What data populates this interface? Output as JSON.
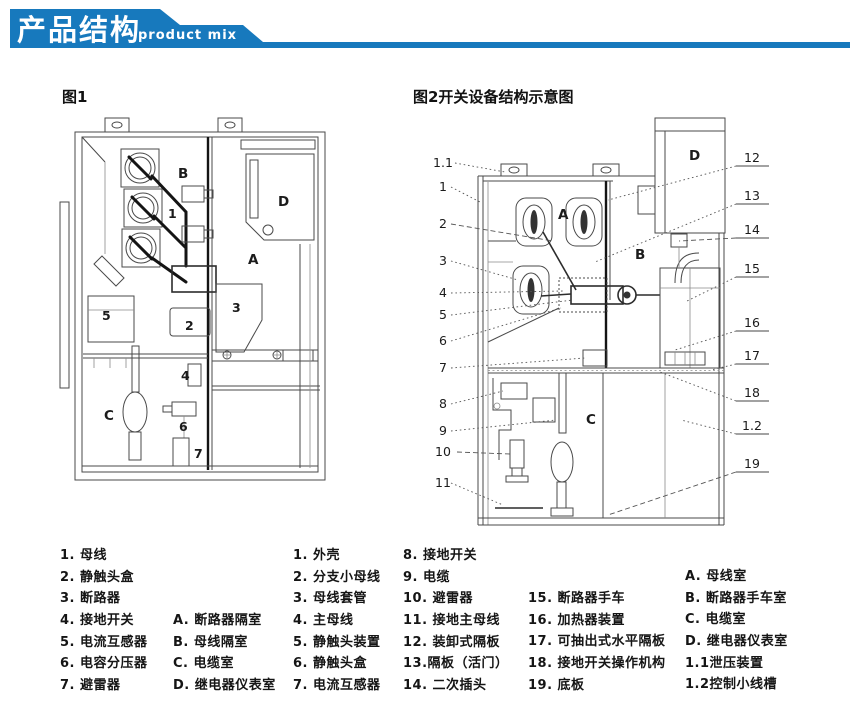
{
  "header": {
    "title": "产品结构",
    "subtitle": "product mix",
    "banner_color": "#1779bd"
  },
  "figures": {
    "fig1": {
      "caption": "图1",
      "part_labels": [
        "1",
        "2",
        "3",
        "4",
        "5",
        "6",
        "7"
      ],
      "compartment_labels": [
        "A",
        "B",
        "C",
        "D"
      ]
    },
    "fig2": {
      "caption": "图2开关设备结构示意图",
      "left_callouts": [
        "1.1",
        "1",
        "2",
        "3",
        "4",
        "5",
        "6",
        "7",
        "8",
        "9",
        "10",
        "11"
      ],
      "right_callouts": [
        "12",
        "13",
        "14",
        "15",
        "16",
        "17",
        "18",
        "1.2",
        "19"
      ],
      "compartment_labels": [
        "A",
        "B",
        "C",
        "D"
      ]
    }
  },
  "legend": {
    "fig1_parts": [
      "1. 母线",
      "2. 静触头盒",
      "3. 断路器",
      "4. 接地开关",
      "5. 电流互感器",
      "6. 电容分压器",
      "7. 避雷器"
    ],
    "fig1_compartments": [
      "A. 断路器隔室",
      "B. 母线隔室",
      "C. 电缆室",
      "D. 继电器仪表室"
    ],
    "fig2_parts_a": [
      "1. 外壳",
      "2. 分支小母线",
      "3. 母线套管",
      "4. 主母线",
      "5. 静触头装置",
      "6. 静触头盒",
      "7. 电流互感器"
    ],
    "fig2_parts_b": [
      "8. 接地开关",
      "9. 电缆",
      "10. 避雷器",
      "11. 接地主母线",
      "12. 装卸式隔板",
      "13.隔板（活门）",
      "14. 二次插头"
    ],
    "fig2_parts_c": [
      "15. 断路器手车",
      "16. 加热器装置",
      "17. 可抽出式水平隔板",
      "18. 接地开关操作机构",
      "19. 底板"
    ],
    "fig2_compartments": [
      "A. 母线室",
      "B. 断路器手车室",
      "C. 电缆室",
      "D. 继电器仪表室",
      "1.1泄压装置",
      "1.2控制小线槽"
    ]
  }
}
